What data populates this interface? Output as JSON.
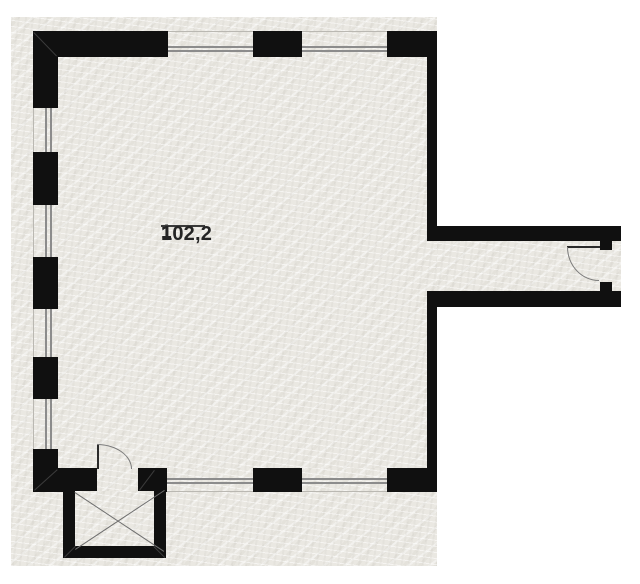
{
  "plan": {
    "room_number": "1",
    "room_area": "102,2"
  },
  "colors": {
    "wall": "#101010",
    "paper": "#eae8e2",
    "outside": "#ffffff",
    "window_line": "#8c8c8c",
    "detail_line": "#6e6e6e",
    "text": "#242424"
  }
}
